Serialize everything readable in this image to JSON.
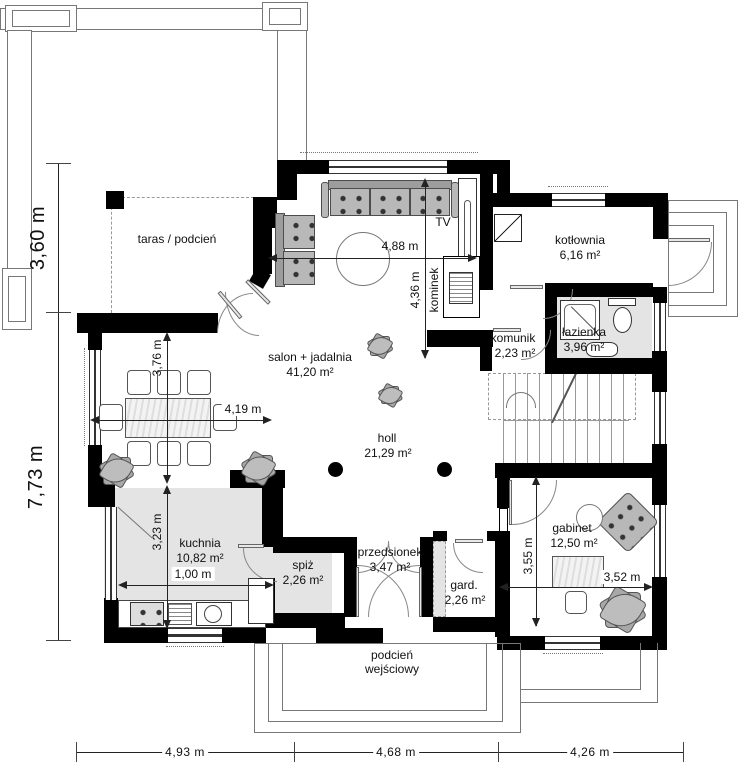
{
  "plan": {
    "title": "Rzut parteru — plan domu",
    "rooms": [
      {
        "id": "taras",
        "name": "taras / podcień",
        "area": ""
      },
      {
        "id": "salon",
        "name": "salon + jadalnia",
        "area": "41,20  m²"
      },
      {
        "id": "kuchnia",
        "name": "kuchnia",
        "area": "10,82 m²"
      },
      {
        "id": "spiz",
        "name": "spiż",
        "area": "2,26 m²"
      },
      {
        "id": "przedsionek",
        "name": "przedsionek",
        "area": "3,47 m²"
      },
      {
        "id": "gard",
        "name": "gard.",
        "area": "2,26 m²"
      },
      {
        "id": "holl",
        "name": "holl",
        "area": "21,29 m²"
      },
      {
        "id": "komunik",
        "name": "komunik",
        "area": "2,23 m²"
      },
      {
        "id": "kotlownia",
        "name": "kotłownia",
        "area": "6,16 m²"
      },
      {
        "id": "lazienka",
        "name": "łazienka",
        "area": "3,96 m²"
      },
      {
        "id": "gabinet",
        "name": "gabinet",
        "area": "12,50 m²"
      },
      {
        "id": "podcien",
        "name": "podcień wejściowy",
        "area": ""
      }
    ],
    "labels": {
      "tv": "TV",
      "fireplace": "kominek"
    },
    "dimensions": {
      "left_upper": "3,60 m",
      "left_lower": "7,73 m",
      "bottom": [
        "4,93 m",
        "4,68 m",
        "4,26 m"
      ],
      "salon_width": "4,88 m",
      "salon_height": "4,36 m",
      "dining_height": "3,76 m",
      "dining_width": "4,19 m",
      "kitchen_height": "3,23 m",
      "kitchen_width": "1,00 m",
      "gabinet_height": "3,55 m",
      "gabinet_width": "3,52 m"
    },
    "colors": {
      "wall": "#000000",
      "shaded_room": "#e4e4e4",
      "furniture": "#b8b8b8",
      "outline": "#777777"
    }
  }
}
